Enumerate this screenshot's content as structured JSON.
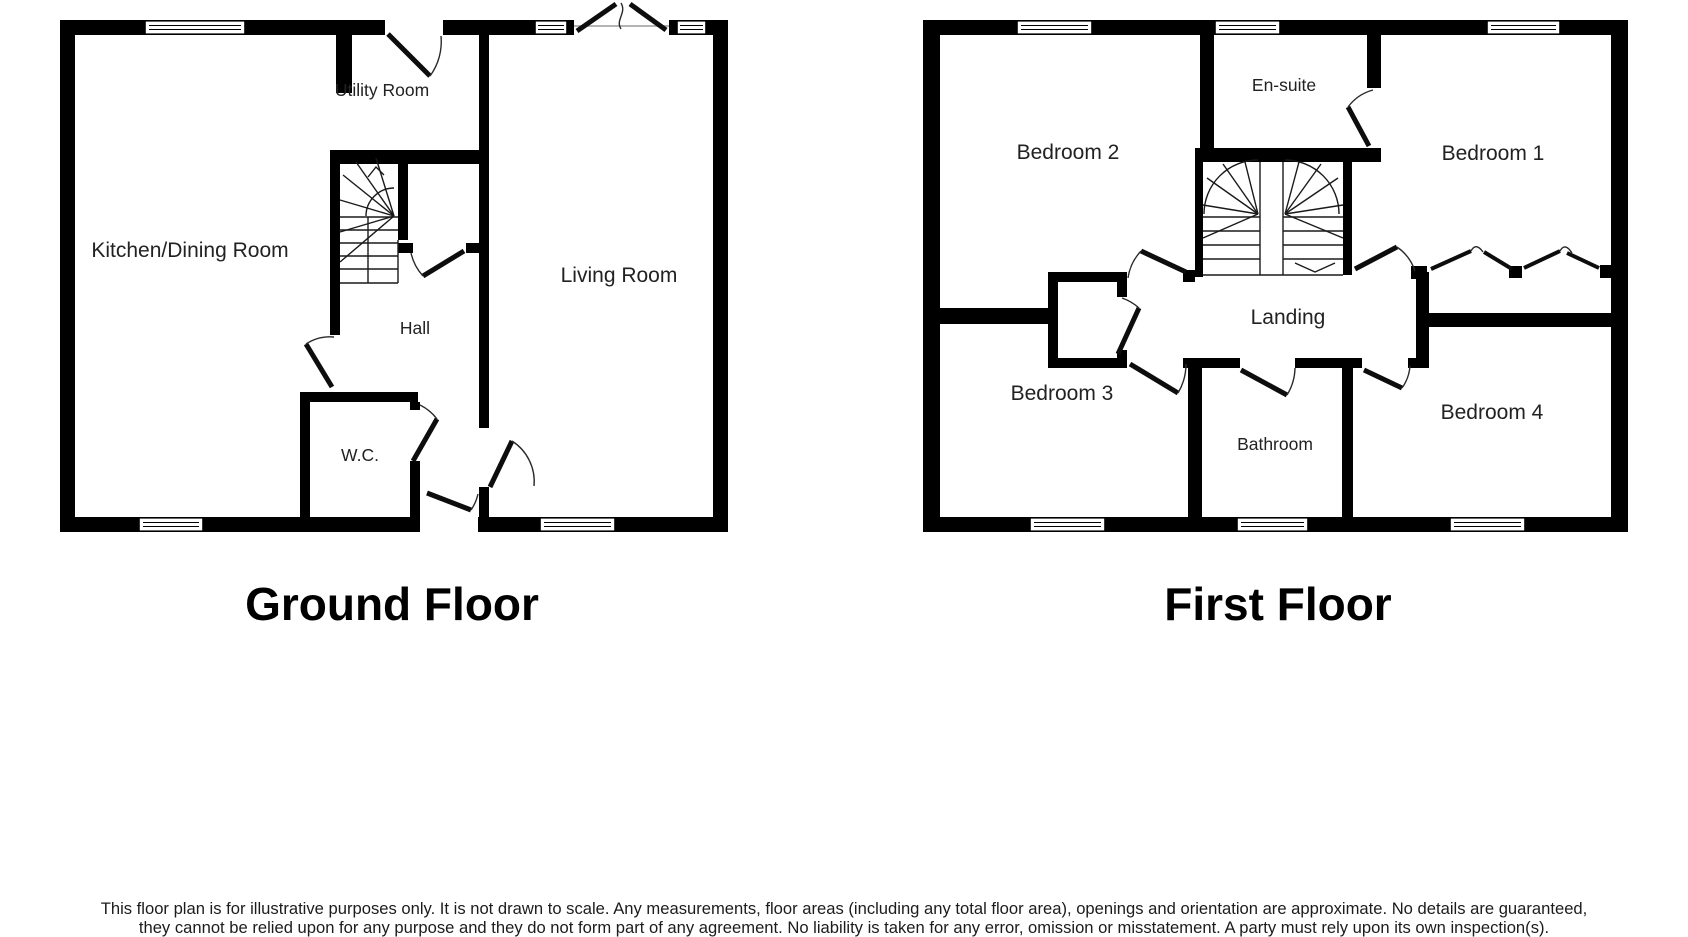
{
  "floors": [
    {
      "title": "Ground Floor",
      "rooms": [
        {
          "label": "Kitchen/Dining Room"
        },
        {
          "label": "Utility Room"
        },
        {
          "label": "Living Room"
        },
        {
          "label": "Hall"
        },
        {
          "label": "W.C."
        }
      ]
    },
    {
      "title": "First Floor",
      "rooms": [
        {
          "label": "Bedroom 2"
        },
        {
          "label": "En-suite"
        },
        {
          "label": "Bedroom 1"
        },
        {
          "label": "Landing"
        },
        {
          "label": "Bedroom 3"
        },
        {
          "label": "Bathroom"
        },
        {
          "label": "Bedroom 4"
        }
      ]
    }
  ],
  "disclaimer": {
    "line1": "This floor plan is for illustrative purposes only. It is not drawn to scale. Any measurements, floor areas (including any total floor area), openings and orientation are approximate. No details are guaranteed,",
    "line2": "they cannot be relied upon for any purpose and they do not form part of any agreement. No liability is taken for any error, omission or misstatement. A party must rely upon its own inspection(s)."
  },
  "colors": {
    "wall": "#000000",
    "background": "#ffffff",
    "label_text": "#222222",
    "disclaimer_text": "#1c1c1c"
  }
}
